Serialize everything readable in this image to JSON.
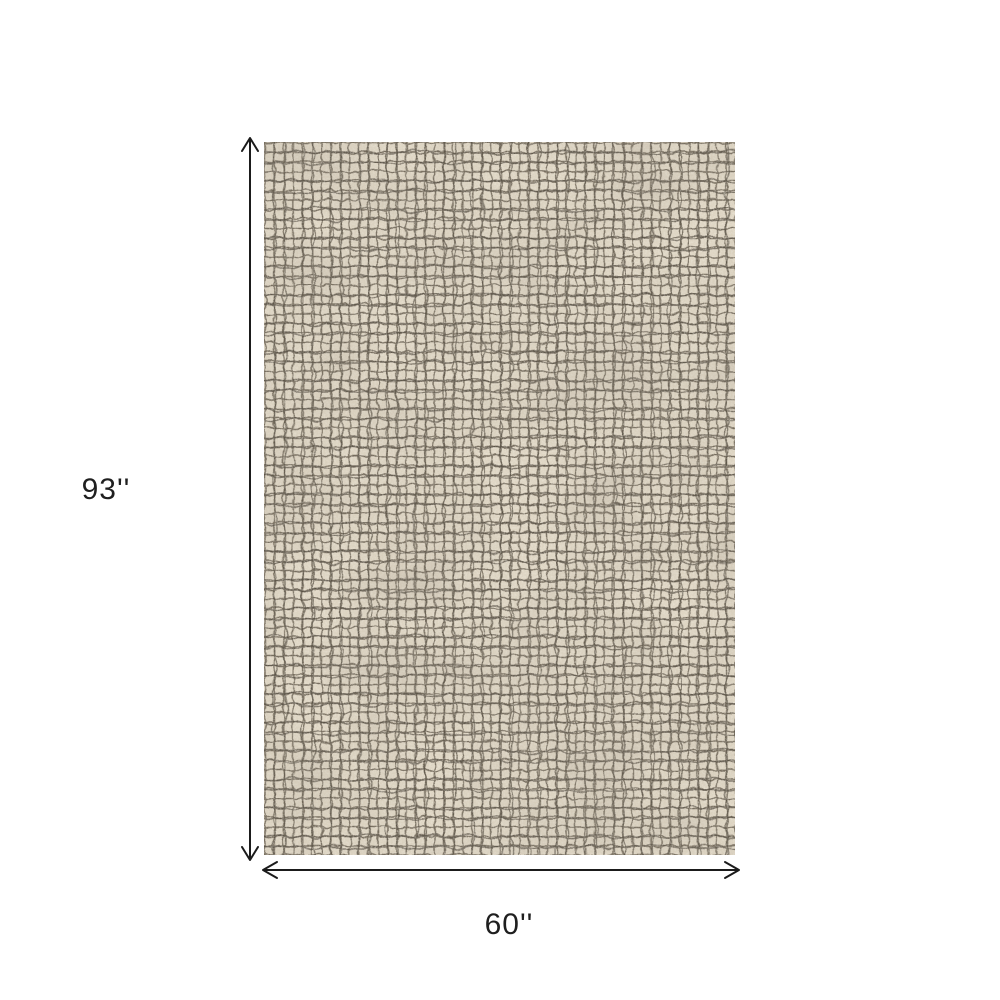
{
  "diagram": {
    "background_color": "#ffffff",
    "height_label": "93''",
    "width_label": "60''",
    "arrow_color": "#1b1b1b",
    "label_color": "#1f1f1f",
    "rug": {
      "name": "grid-pattern-rug",
      "base_color": "#ded5c3",
      "grid_line_color": "#756c5d",
      "grid_line_dark_color": "#50483c",
      "speckle_color": "#e7dfcc"
    }
  }
}
